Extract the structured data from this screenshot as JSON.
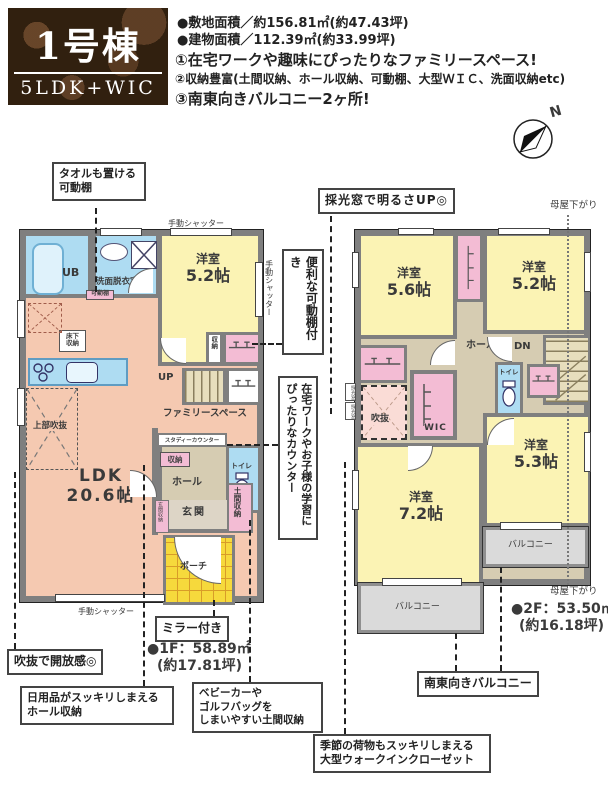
{
  "header": {
    "building_no": "1号棟",
    "layout": "5LDK+WIC",
    "site_area": "●敷地面積／約156.81㎡(約47.43坪)",
    "building_area": "●建物面積／112.39㎡(約33.99坪)",
    "feature1": "①在宅ワークや趣味にぴったりなファミリースペース!",
    "feature2": "②収納豊富(土間収納、ホール収納、可動棚、大型ＷＩＣ、洗面収納etc)",
    "feature3": "③南東向きバルコニー2ヶ所!"
  },
  "compass": {
    "north": "N"
  },
  "f1": {
    "shutter": "手動シャッター",
    "ub": "UB",
    "washroom": "洗面脱衣室",
    "movable_shelf": "可動棚",
    "bedroom": "洋室",
    "bedroom_size": "5.2帖",
    "closet": "収納",
    "floor_storage": "床下収納",
    "up": "UP",
    "void_above": "上部吹抜",
    "ldk": "LDK",
    "ldk_size": "20.6帖",
    "family_space": "ファミリースペース",
    "study_counter": "スタディーカウンター",
    "hall_closet": "収納",
    "hall": "ホール",
    "toilet": "トイレ",
    "entrance": "玄関",
    "entrance_storage": "玄関収納",
    "doma_storage": "土間収納",
    "porch": "ポーチ",
    "area": "●1F：58.89㎡",
    "area_tsubo": "(約17.81坪)"
  },
  "f2": {
    "bed1": "洋室",
    "bed1_size": "5.6帖",
    "bed2": "洋室",
    "bed2_size": "5.2帖",
    "bed3": "洋室",
    "bed3_size": "7.2帖",
    "bed4": "洋室",
    "bed4_size": "5.3帖",
    "hall": "ホール",
    "dn": "DN",
    "toilet": "トイレ",
    "wic": "WIC",
    "void": "吹抜",
    "skylight": "採光窓",
    "balcony": "バルコニー",
    "moya": "母屋下がり",
    "area": "●2F：53.50㎡",
    "area_tsubo": "(約16.18坪)"
  },
  "callouts": {
    "towel": "タオルも置ける\n可動棚",
    "skylight_up": "採光窓で明るさUP◎",
    "shelf": "便利な可動棚付き",
    "counter": "在宅ワークやお子様の学習にぴったりなカウンター",
    "void_open": "吹抜で開放感◎",
    "mirror": "ミラー付き",
    "hall_storage": "日用品がスッキリしまえる\nホール収納",
    "doma": "ベビーカーや\nゴルフバッグを\nしまいやすい土間収納",
    "balcony_se": "南東向きバルコニー",
    "wic_big": "季節の荷物もスッキリしまえる\n大型ウォークインクローゼット"
  },
  "colors": {
    "ldk": "#f5c9b1",
    "bedroom": "#fbf3b4",
    "wet_area": "#aedcf2",
    "closet": "#f3bcd4",
    "hall": "#d6ccb2",
    "void_2f": "#fadcd6",
    "porch": "#f6d93c",
    "balcony": "#dadada",
    "wall": "#7f7f7f",
    "brand_bg": "#31200f"
  }
}
